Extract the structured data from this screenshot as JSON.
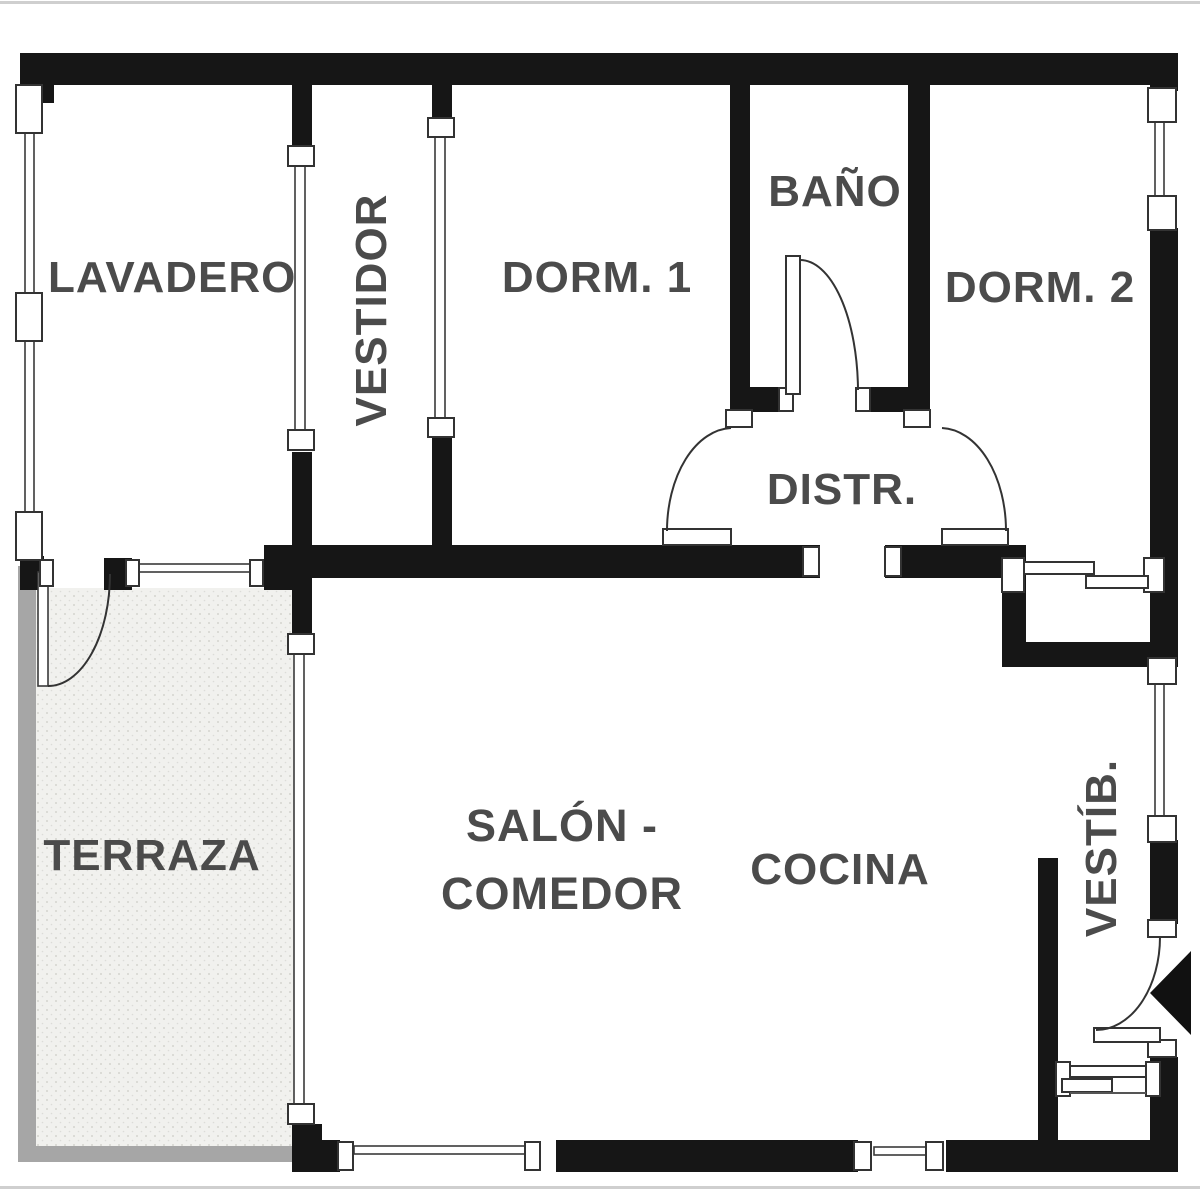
{
  "page": {
    "type": "apartment-floor-plan"
  },
  "rooms": {
    "lavadero": {
      "label": "LAVADERO"
    },
    "vestidor": {
      "label": "VESTIDOR"
    },
    "dorm1": {
      "label": "DORM. 1"
    },
    "bano": {
      "label": "BAÑO"
    },
    "dorm2": {
      "label": "DORM. 2"
    },
    "distr": {
      "label": "DISTR."
    },
    "terraza": {
      "label": "TERRAZA"
    },
    "salon_comedor": {
      "line1": "SALÓN -",
      "line2": "COMEDOR"
    },
    "cocina": {
      "label": "COCINA"
    },
    "vestibulo": {
      "label": "VESTÍB."
    }
  },
  "colors": {
    "wall": "#161616",
    "label": "#4b4b4b",
    "terrace_border": "#a6a6a6",
    "line": "#3a3a3a"
  }
}
